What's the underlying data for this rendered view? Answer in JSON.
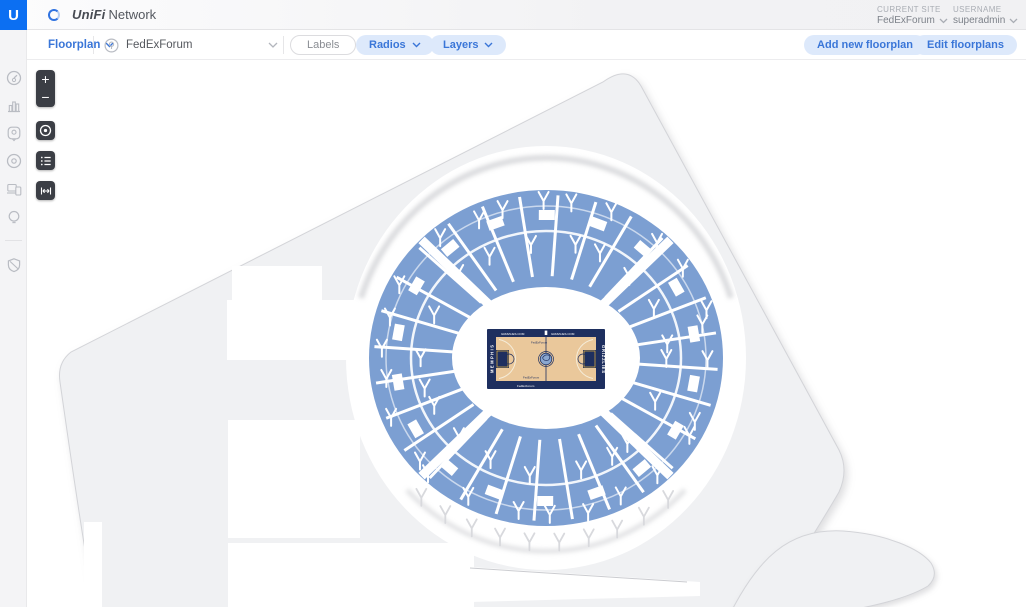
{
  "app": {
    "logo_letter": "U",
    "brand": "UniFi",
    "brand_suffix": "Network"
  },
  "top_right": {
    "site_label": "CURRENT SITE",
    "site_value": "FedExForum",
    "user_label": "USERNAME",
    "user_value": "superadmin"
  },
  "toolbar": {
    "floorplan": "Floorplan",
    "site_selector": "FedExForum",
    "labels": "Labels",
    "radios": "Radios",
    "layers": "Layers",
    "add_floorplan": "Add new floorplan",
    "edit_floorplans": "Edit floorplans"
  },
  "sidebar": {
    "items": [
      {
        "icon": "dashboard-gauge-icon"
      },
      {
        "icon": "statistics-bars-icon"
      },
      {
        "icon": "map-pin-icon"
      },
      {
        "icon": "devices-circle-icon"
      },
      {
        "icon": "clients-devices-icon"
      },
      {
        "icon": "insights-bulb-icon"
      },
      {
        "icon": "settings-shield-icon"
      }
    ]
  },
  "map_controls": {
    "zoom_in": "+",
    "zoom_out": "−",
    "icons": [
      "locate-target-icon",
      "floorplan-list-icon",
      "measure-width-icon"
    ]
  },
  "court": {
    "top_left_ad": "GRIZZLIES.COM",
    "top_right_ad": "GRIZZLIES.COM",
    "left_baseline": "MEMPHIS",
    "right_baseline": "GRIZZLIES",
    "center_top": "FedExForum",
    "center_bottom": "FedExForum",
    "bottom_band": "FedExForum"
  },
  "colors": {
    "accent_blue": "#0c6ff2",
    "chip_bg": "#dde9fb",
    "chip_text": "#3a76d8",
    "seat_blue": "#7c9fd2",
    "building": "#f0f1f3",
    "building_border": "#d3d4d8",
    "court_navy": "#1e2f5f",
    "court_wood": "#eac89b",
    "court_gold": "#e8b43d",
    "logo_blue": "#8aa7d0"
  }
}
